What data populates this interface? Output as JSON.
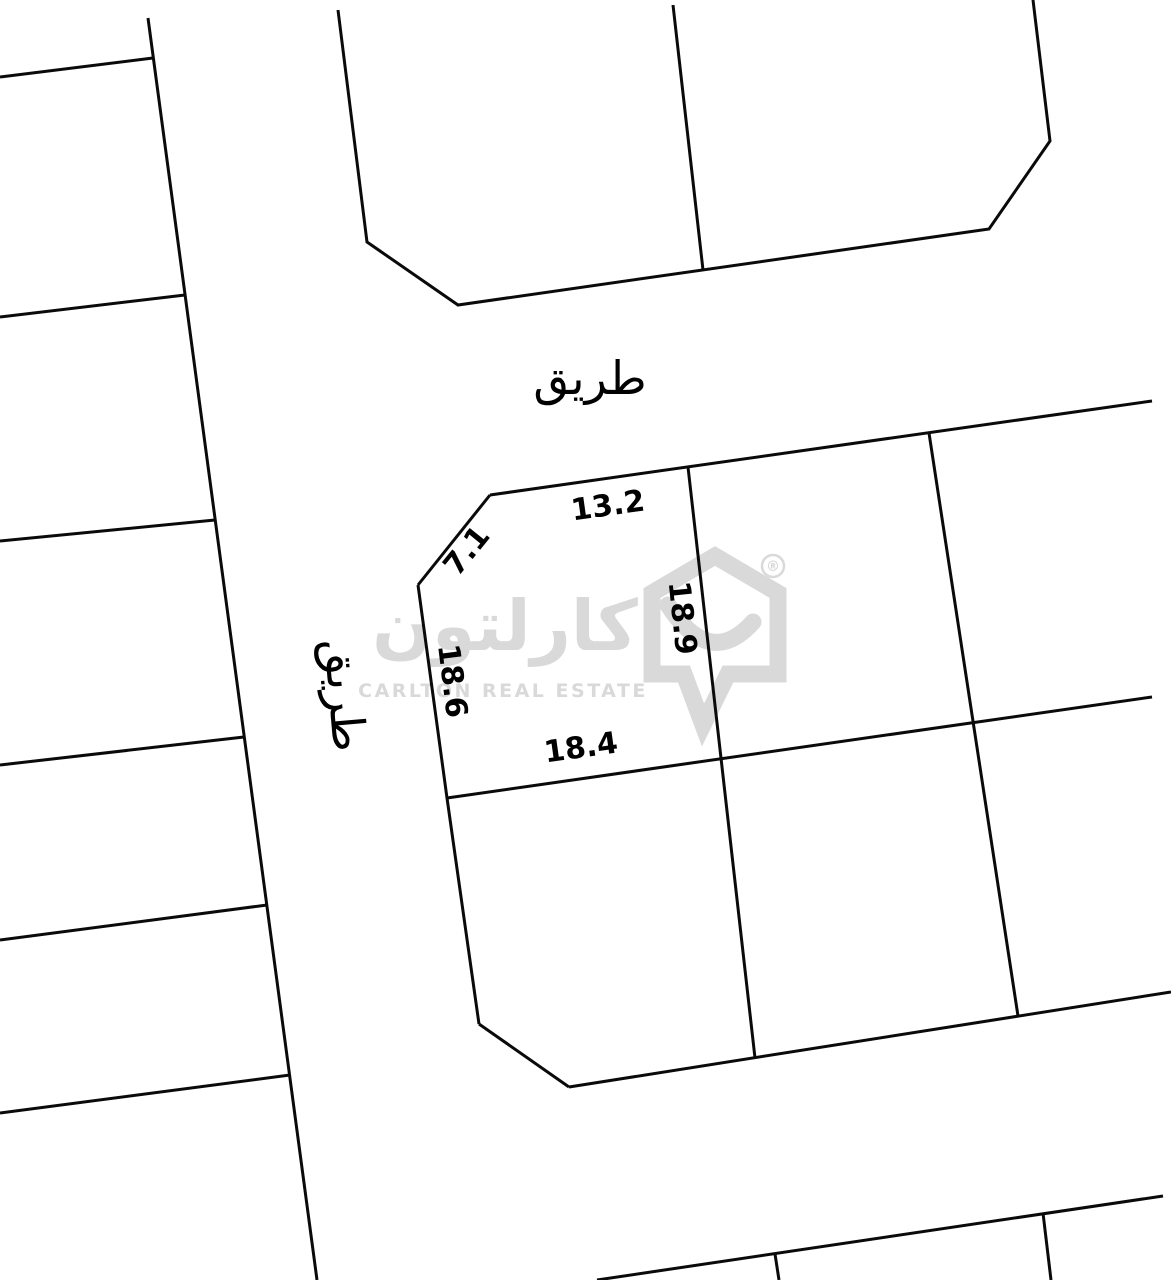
{
  "map": {
    "roads": {
      "top_road_label": "طريق",
      "west_road_label": "طريق"
    },
    "parcel": {
      "dimensions": {
        "top": "13.2",
        "chamfer": "7.1",
        "left": "18.6",
        "right": "18.9",
        "bottom": "18.4"
      }
    },
    "colors": {
      "line": "#0a0a0a",
      "label_text": "#000000",
      "watermark": "#d9d9d9",
      "background": "#ffffff"
    }
  },
  "watermark": {
    "brand_arabic": "كارلتون",
    "brand_english": "CARLTON REAL ESTATE",
    "registered_mark": "®"
  }
}
